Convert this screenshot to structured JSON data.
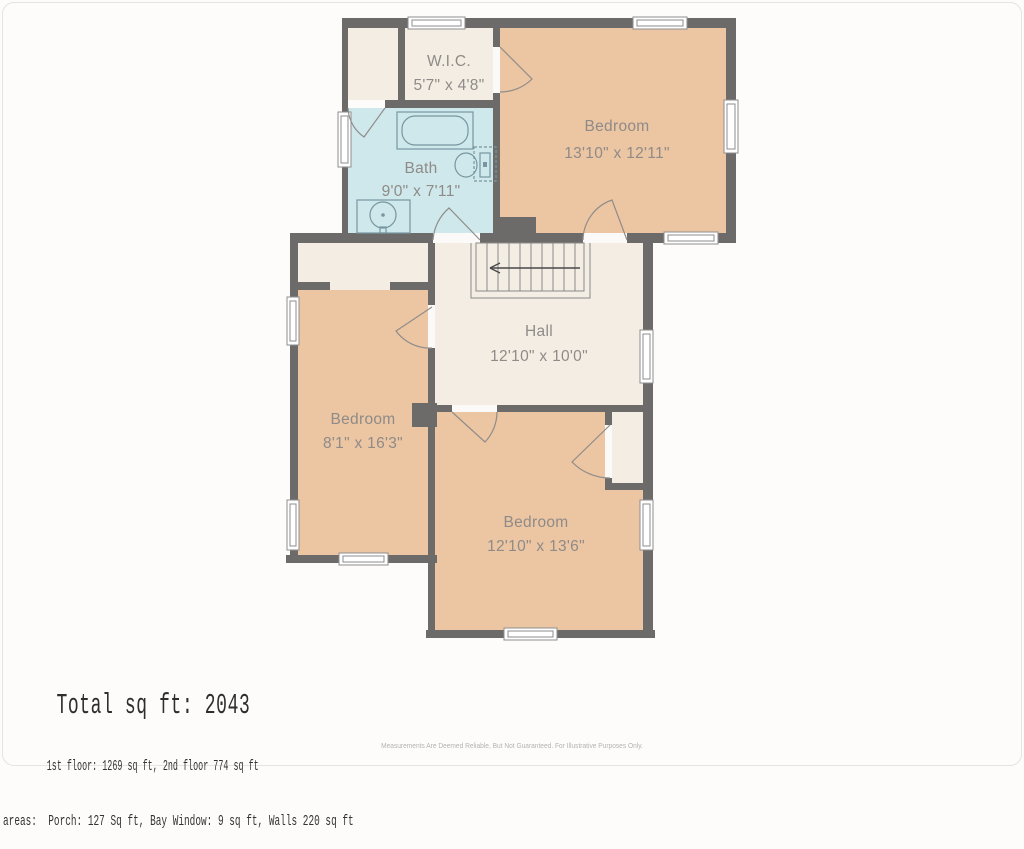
{
  "plan": {
    "floor_title": "2nd floor plan",
    "rooms": [
      {
        "name": "W.I.C.",
        "dims": "5'7\" x 4'8\""
      },
      {
        "name": "Bath",
        "dims": "9'0\" x 7'11\""
      },
      {
        "name": "Bedroom",
        "dims": "13'10\" x 12'11\""
      },
      {
        "name": "Hall",
        "dims": "12'10\" x 10'0\""
      },
      {
        "name": "Bedroom",
        "dims": "8'1\" x 16'3\""
      },
      {
        "name": "Bedroom",
        "dims": "12'10\" x 13'6\""
      }
    ]
  },
  "summary": {
    "total": "Total sq ft: 2043",
    "floors": "1st floor: 1269 sq ft, 2nd floor 774 sq ft",
    "excluded": "excluded areas:  Porch: 127 Sq ft, Bay Window: 9 sq ft, Walls 220 sq ft"
  },
  "disclaimer": "Measurements Are Deemed Reliable, But Not Guaranteed. For Illustrative Purposes Only.",
  "colors": {
    "wall": "#6d6a6a",
    "room_tan": "#ecc5a2",
    "room_cream": "#f4ede4",
    "room_blue": "#cfe8eb",
    "door_gap": "#fbfaf8",
    "label_text": "#8e8b88",
    "fixture_line": "#7796a0",
    "stair_line": "#8a8a8a",
    "summary_text": "#2e2e2e",
    "disclaimer_text": "#b5b2b0"
  }
}
